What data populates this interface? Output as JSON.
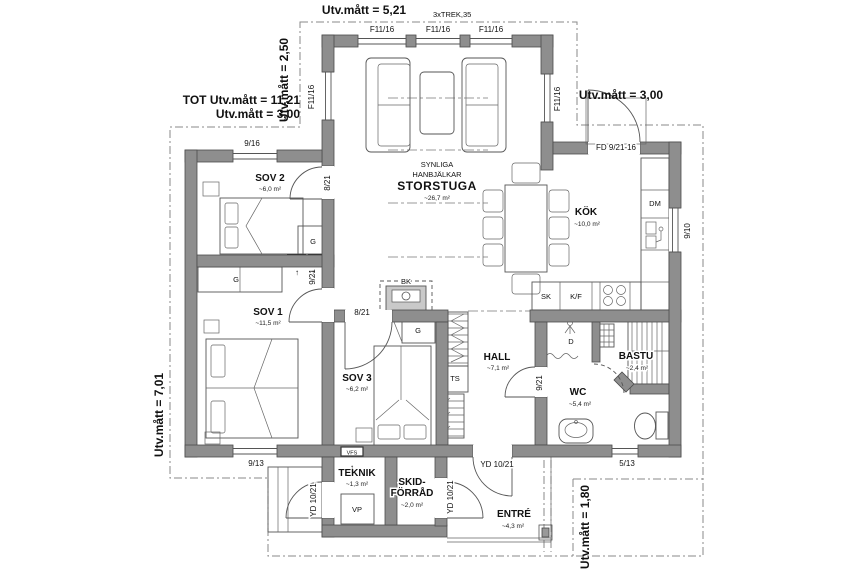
{
  "plan": {
    "colors": {
      "wall": "#8e8e8e",
      "line": "#555555",
      "dash": "#8a8a8a"
    },
    "dimensions": {
      "top": "Utv.mått = 5,21",
      "top_note": "3xTREK,35",
      "top_left_vertical": "Utv.mått = 2,50",
      "left_total": "TOT Utv.mått = 11,21",
      "left_sub": "Utv.mått = 3,00",
      "left_vertical": "Utv.mått = 7,01",
      "top_right": "Utv.mått = 3,00",
      "bottom_right_vertical": "Utv.mått = 1,80"
    },
    "rooms": {
      "storstuga": {
        "note1": "SYNLIGA",
        "note2": "HANBJÄLKAR",
        "name": "STORSTUGA",
        "area": "~26,7 m²"
      },
      "sov2": {
        "name": "SOV 2",
        "area": "~6,0 m²"
      },
      "sov1": {
        "name": "SOV 1",
        "area": "~11,5 m²"
      },
      "sov3": {
        "name": "SOV 3",
        "area": "~6,2 m²"
      },
      "kok": {
        "name": "KÖK",
        "area": "~10,0 m²"
      },
      "hall": {
        "name": "HALL",
        "area": "~7,1 m²"
      },
      "wc": {
        "name": "WC",
        "area": "~5,4 m²"
      },
      "bastu": {
        "name": "BASTU",
        "area": "~2,4 m²"
      },
      "teknik": {
        "name": "TEKNIK",
        "area": "~1,3 m²"
      },
      "skidforrad": {
        "name1": "SKID-",
        "name2": "FÖRRÅD",
        "area": "~2,0 m²"
      },
      "entre": {
        "name": "ENTRÉ",
        "area": "~4,3 m²"
      }
    },
    "openings": {
      "f11": "F11/16",
      "w916": "9/16",
      "fd": "FD 9/21-16",
      "w910": "9/10",
      "d8": "8/21",
      "d9": "9/21",
      "w913": "9/13",
      "yd": "YD 10/21",
      "w513": "5/13"
    },
    "fixtures": {
      "g": "G",
      "dm": "DM",
      "sk": "SK",
      "kf": "K/F",
      "vp": "VP",
      "vfs": "VFS",
      "ts": "TS",
      "bk": "BK",
      "d": "D"
    }
  }
}
